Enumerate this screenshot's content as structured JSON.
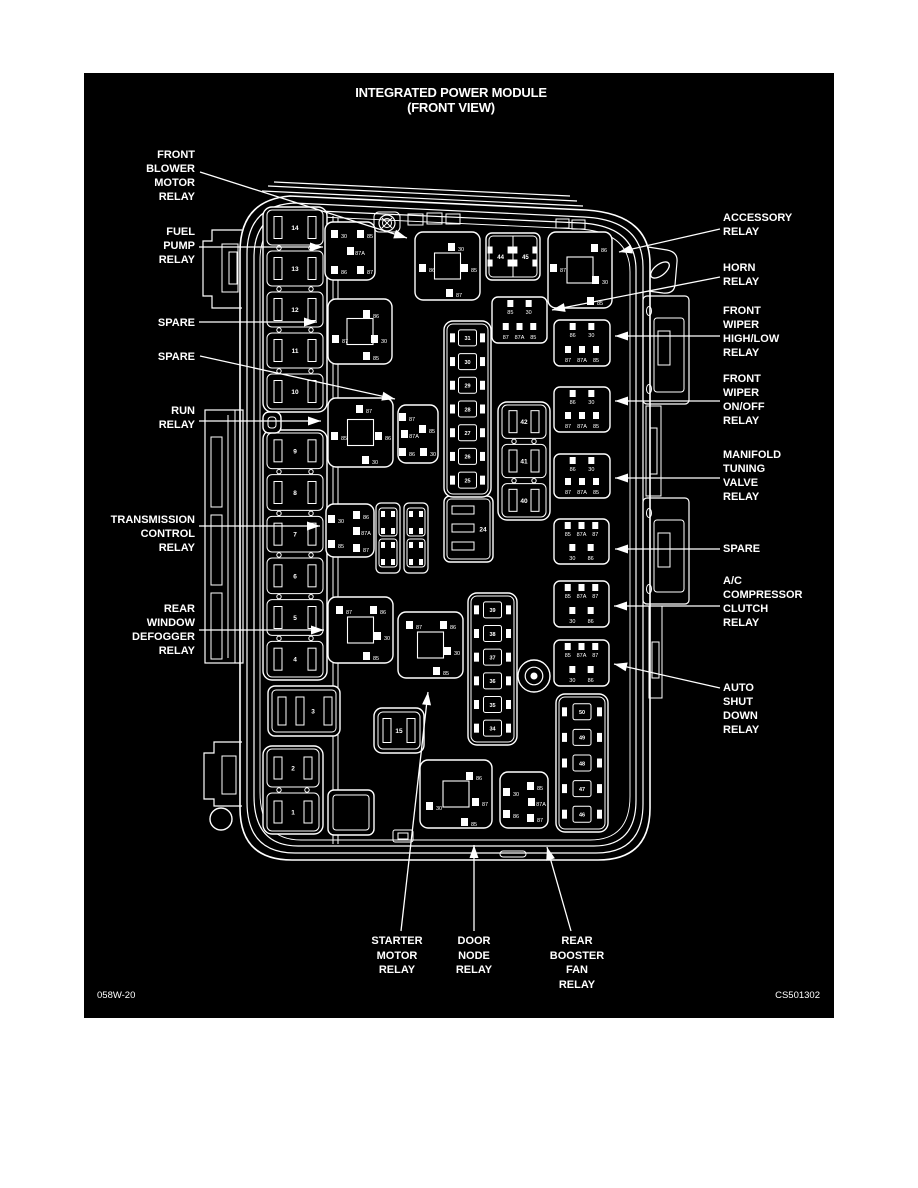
{
  "title": {
    "line1": "INTEGRATED POWER MODULE",
    "line2": "(FRONT VIEW)"
  },
  "footer": {
    "left": "058W-20",
    "right": "CS501302"
  },
  "colors": {
    "ink": "#ffffff",
    "paper": "#000000",
    "page": "#ffffff"
  },
  "callouts": [
    {
      "id": "front-blower-motor-relay",
      "side": "left",
      "x": 195,
      "lines": [
        "FRONT",
        "BLOWER",
        "MOTOR",
        "RELAY"
      ],
      "ys": [
        158,
        172,
        186,
        200
      ],
      "leader": [
        [
          200,
          172
        ],
        [
          407,
          238
        ]
      ]
    },
    {
      "id": "fuel-pump-relay",
      "side": "left",
      "x": 195,
      "lines": [
        "FUEL",
        "PUMP",
        "RELAY"
      ],
      "ys": [
        235,
        249,
        263
      ],
      "leader": [
        [
          199,
          247
        ],
        [
          323,
          247
        ]
      ]
    },
    {
      "id": "spare-1",
      "side": "left",
      "x": 195,
      "lines": [
        "SPARE"
      ],
      "ys": [
        326
      ],
      "leader": [
        [
          199,
          322
        ],
        [
          317,
          322
        ]
      ]
    },
    {
      "id": "spare-2",
      "side": "left",
      "x": 195,
      "lines": [
        "SPARE"
      ],
      "ys": [
        360
      ],
      "leader": [
        [
          200,
          356
        ],
        [
          395,
          399
        ]
      ]
    },
    {
      "id": "run-relay",
      "side": "left",
      "x": 195,
      "lines": [
        "RUN",
        "RELAY"
      ],
      "ys": [
        414,
        428
      ],
      "leader": [
        [
          199,
          421
        ],
        [
          321,
          421
        ]
      ]
    },
    {
      "id": "transmission-control-relay",
      "side": "left",
      "x": 195,
      "lines": [
        "TRANSMISSION",
        "CONTROL",
        "RELAY"
      ],
      "ys": [
        523,
        537,
        551
      ],
      "leader": [
        [
          199,
          526
        ],
        [
          320,
          526
        ]
      ]
    },
    {
      "id": "rear-window-defogger-relay",
      "side": "left",
      "x": 195,
      "lines": [
        "REAR",
        "WINDOW",
        "DEFOGGER",
        "RELAY"
      ],
      "ys": [
        612,
        626,
        640,
        654
      ],
      "leader": [
        [
          199,
          630
        ],
        [
          324,
          630
        ]
      ]
    },
    {
      "id": "accessory-relay",
      "side": "right",
      "x": 723,
      "lines": [
        "ACCESSORY",
        "RELAY"
      ],
      "ys": [
        221,
        235
      ],
      "leader": [
        [
          720,
          229
        ],
        [
          619,
          252
        ]
      ]
    },
    {
      "id": "horn-relay",
      "side": "right",
      "x": 723,
      "lines": [
        "HORN",
        "RELAY"
      ],
      "ys": [
        271,
        285
      ],
      "leader": [
        [
          720,
          277
        ],
        [
          552,
          310
        ]
      ]
    },
    {
      "id": "front-wiper-highlow-relay",
      "side": "right",
      "x": 723,
      "lines": [
        "FRONT",
        "WIPER",
        "HIGH/LOW",
        "RELAY"
      ],
      "ys": [
        314,
        328,
        342,
        356
      ],
      "leader": [
        [
          720,
          336
        ],
        [
          615,
          336
        ]
      ]
    },
    {
      "id": "front-wiper-onoff-relay",
      "side": "right",
      "x": 723,
      "lines": [
        "FRONT",
        "WIPER",
        "ON/OFF",
        "RELAY"
      ],
      "ys": [
        382,
        396,
        410,
        424
      ],
      "leader": [
        [
          720,
          401
        ],
        [
          615,
          401
        ]
      ]
    },
    {
      "id": "manifold-tuning-valve-relay",
      "side": "right",
      "x": 723,
      "lines": [
        "MANIFOLD",
        "TUNING",
        "VALVE",
        "RELAY"
      ],
      "ys": [
        458,
        472,
        486,
        500
      ],
      "leader": [
        [
          720,
          478
        ],
        [
          615,
          478
        ]
      ]
    },
    {
      "id": "spare-right",
      "side": "right",
      "x": 723,
      "lines": [
        "SPARE"
      ],
      "ys": [
        552
      ],
      "leader": [
        [
          720,
          549
        ],
        [
          615,
          549
        ]
      ]
    },
    {
      "id": "ac-compressor-clutch-relay",
      "side": "right",
      "x": 723,
      "lines": [
        "A/C",
        "COMPRESSOR",
        "CLUTCH",
        "RELAY"
      ],
      "ys": [
        584,
        598,
        612,
        626
      ],
      "leader": [
        [
          720,
          606
        ],
        [
          614,
          606
        ]
      ]
    },
    {
      "id": "auto-shut-down-relay",
      "side": "right",
      "x": 723,
      "lines": [
        "AUTO",
        "SHUT",
        "DOWN",
        "RELAY"
      ],
      "ys": [
        691,
        705,
        719,
        733
      ],
      "leader": [
        [
          720,
          688
        ],
        [
          614,
          664
        ]
      ]
    },
    {
      "id": "starter-motor-relay",
      "side": "bottom",
      "x": 397,
      "lines": [
        "STARTER",
        "MOTOR",
        "RELAY"
      ],
      "ys": [
        944,
        959,
        973
      ],
      "leader": [
        [
          401,
          931
        ],
        [
          428,
          692
        ]
      ]
    },
    {
      "id": "door-node-relay",
      "side": "bottom",
      "x": 474,
      "lines": [
        "DOOR",
        "NODE",
        "RELAY"
      ],
      "ys": [
        944,
        959,
        973
      ],
      "leader": [
        [
          474,
          931
        ],
        [
          474,
          845
        ]
      ]
    },
    {
      "id": "rear-booster-fan-relay",
      "side": "bottom",
      "x": 577,
      "lines": [
        "REAR",
        "BOOSTER",
        "FAN",
        "RELAY"
      ],
      "ys": [
        944,
        959,
        973,
        988
      ],
      "leader": [
        [
          571,
          931
        ],
        [
          547,
          847
        ]
      ]
    }
  ],
  "components": [
    {
      "id": "fuse-column-top",
      "type": "fusecol",
      "x": 263,
      "y": 207,
      "w": 64,
      "h": 205,
      "fuses": [
        "14",
        "13",
        "12",
        "11",
        "10"
      ]
    },
    {
      "id": "fuse-column-mid",
      "type": "fusecol",
      "x": 263,
      "y": 430,
      "w": 64,
      "h": 250,
      "fuses": [
        "9",
        "8",
        "7",
        "6",
        "5",
        "4"
      ]
    },
    {
      "id": "fuse-column-low",
      "type": "fusecol",
      "x": 263,
      "y": 746,
      "w": 60,
      "h": 88,
      "fuses": [
        "2",
        "1"
      ]
    },
    {
      "id": "fuse-column-42",
      "type": "fusecol",
      "x": 498,
      "y": 402,
      "w": 52,
      "h": 118,
      "fuses": [
        "42",
        "41",
        "40"
      ]
    },
    {
      "id": "fuse-box-3",
      "type": "hfuse",
      "x": 268,
      "y": 686,
      "w": 72,
      "h": 50,
      "label": "3"
    },
    {
      "id": "run-feed-box",
      "type": "blank",
      "x": 263,
      "y": 412,
      "w": 18,
      "h": 21
    },
    {
      "id": "blank-box",
      "type": "blank",
      "x": 328,
      "y": 790,
      "w": 46,
      "h": 45
    },
    {
      "id": "fuse-15",
      "type": "fuse15",
      "x": 374,
      "y": 708,
      "w": 50,
      "h": 45,
      "label": "15"
    },
    {
      "id": "fuse-24",
      "type": "vfuse",
      "x": 444,
      "y": 496,
      "w": 49,
      "h": 66,
      "label": "24"
    },
    {
      "id": "minifuse-column-upper",
      "type": "minicol",
      "x": 444,
      "y": 321,
      "w": 47,
      "h": 176,
      "fuses": [
        "31",
        "30",
        "29",
        "28",
        "27",
        "26",
        "25"
      ]
    },
    {
      "id": "minifuse-column-center",
      "type": "minicol",
      "x": 468,
      "y": 593,
      "w": 49,
      "h": 152,
      "fuses": [
        "39",
        "38",
        "37",
        "36",
        "35",
        "34"
      ]
    },
    {
      "id": "minifuse-column-right",
      "type": "minicol",
      "x": 556,
      "y": 694,
      "w": 52,
      "h": 138,
      "fuses": [
        "50",
        "49",
        "48",
        "47",
        "46"
      ]
    },
    {
      "id": "minifuse-strip-1",
      "type": "ministrip",
      "x": 376,
      "y": 503,
      "w": 24,
      "h": 70
    },
    {
      "id": "minifuse-strip-2",
      "type": "ministrip",
      "x": 404,
      "y": 503,
      "w": 24,
      "h": 70
    },
    {
      "id": "fuse-44-45",
      "type": "fusepair",
      "x": 486,
      "y": 233,
      "w": 54,
      "h": 47,
      "labels": [
        "44",
        "45"
      ]
    },
    {
      "id": "fuel-pump-relay",
      "type": "relay",
      "x": 325,
      "y": 222,
      "w": 50,
      "h": 58,
      "square": false,
      "pins": [
        {
          "t": "30",
          "x": 15,
          "y": 14
        },
        {
          "t": "85",
          "x": 41,
          "y": 14
        },
        {
          "t": "87A",
          "x": 31,
          "y": 31
        },
        {
          "t": "86",
          "x": 15,
          "y": 50
        },
        {
          "t": "87",
          "x": 41,
          "y": 50
        }
      ]
    },
    {
      "id": "front-blower-relay",
      "type": "relay",
      "x": 415,
      "y": 232,
      "w": 65,
      "h": 68,
      "square": true,
      "pins": [
        {
          "t": "30",
          "x": 42,
          "y": 17
        },
        {
          "t": "86",
          "x": 13,
          "y": 38
        },
        {
          "t": "85",
          "x": 55,
          "y": 38
        },
        {
          "t": "87",
          "x": 40,
          "y": 63
        }
      ]
    },
    {
      "id": "accessory-relay",
      "type": "relay",
      "x": 548,
      "y": 232,
      "w": 64,
      "h": 76,
      "square": true,
      "pins": [
        {
          "t": "87",
          "x": 11,
          "y": 38
        },
        {
          "t": "86",
          "x": 52,
          "y": 18
        },
        {
          "t": "30",
          "x": 53,
          "y": 50
        },
        {
          "t": "85",
          "x": 48,
          "y": 71
        }
      ]
    },
    {
      "id": "spare-relay-1",
      "type": "relay",
      "x": 328,
      "y": 299,
      "w": 64,
      "h": 65,
      "square": true,
      "pins": [
        {
          "t": "86",
          "x": 44,
          "y": 17
        },
        {
          "t": "30",
          "x": 52,
          "y": 42
        },
        {
          "t": "87",
          "x": 13,
          "y": 42
        },
        {
          "t": "85",
          "x": 44,
          "y": 59
        }
      ]
    },
    {
      "id": "run-relay",
      "type": "relay",
      "x": 328,
      "y": 398,
      "w": 65,
      "h": 69,
      "square": true,
      "pins": [
        {
          "t": "87",
          "x": 37,
          "y": 13
        },
        {
          "t": "85",
          "x": 12,
          "y": 40
        },
        {
          "t": "86",
          "x": 56,
          "y": 40
        },
        {
          "t": "30",
          "x": 43,
          "y": 64
        }
      ]
    },
    {
      "id": "spare-relay-2",
      "type": "relay",
      "x": 398,
      "y": 405,
      "w": 40,
      "h": 58,
      "square": false,
      "pins": [
        {
          "t": "87",
          "x": 10,
          "y": 14
        },
        {
          "t": "85",
          "x": 30,
          "y": 26
        },
        {
          "t": "87A",
          "x": 12,
          "y": 31
        },
        {
          "t": "86",
          "x": 10,
          "y": 49
        },
        {
          "t": "30",
          "x": 31,
          "y": 49
        }
      ]
    },
    {
      "id": "tcm-relay",
      "type": "relay",
      "x": 326,
      "y": 504,
      "w": 48,
      "h": 53,
      "square": false,
      "pins": [
        {
          "t": "30",
          "x": 11,
          "y": 17
        },
        {
          "t": "86",
          "x": 36,
          "y": 13
        },
        {
          "t": "87A",
          "x": 36,
          "y": 29
        },
        {
          "t": "85",
          "x": 11,
          "y": 42
        },
        {
          "t": "87",
          "x": 36,
          "y": 46
        }
      ]
    },
    {
      "id": "defogger-relay",
      "type": "relay",
      "x": 328,
      "y": 597,
      "w": 65,
      "h": 66,
      "square": true,
      "pins": [
        {
          "t": "87",
          "x": 17,
          "y": 15
        },
        {
          "t": "86",
          "x": 51,
          "y": 15
        },
        {
          "t": "30",
          "x": 55,
          "y": 41
        },
        {
          "t": "85",
          "x": 44,
          "y": 61
        }
      ]
    },
    {
      "id": "starter-relay",
      "type": "relay",
      "x": 398,
      "y": 612,
      "w": 65,
      "h": 66,
      "square": true,
      "pins": [
        {
          "t": "87",
          "x": 17,
          "y": 15
        },
        {
          "t": "86",
          "x": 51,
          "y": 15
        },
        {
          "t": "30",
          "x": 55,
          "y": 41
        },
        {
          "t": "85",
          "x": 44,
          "y": 61
        }
      ]
    },
    {
      "id": "door-node-relay",
      "type": "relay",
      "x": 420,
      "y": 760,
      "w": 72,
      "h": 68,
      "square": true,
      "pins": [
        {
          "t": "86",
          "x": 55,
          "y": 18
        },
        {
          "t": "87",
          "x": 61,
          "y": 44
        },
        {
          "t": "30",
          "x": 15,
          "y": 48
        },
        {
          "t": "85",
          "x": 50,
          "y": 64
        }
      ]
    },
    {
      "id": "booster-relay",
      "type": "relay",
      "x": 500,
      "y": 772,
      "w": 48,
      "h": 56,
      "square": false,
      "pins": [
        {
          "t": "30",
          "x": 12,
          "y": 22
        },
        {
          "t": "86",
          "x": 12,
          "y": 44
        },
        {
          "t": "85",
          "x": 36,
          "y": 16
        },
        {
          "t": "87A",
          "x": 37,
          "y": 32
        },
        {
          "t": "87",
          "x": 36,
          "y": 48
        }
      ]
    },
    {
      "id": "horn-relay",
      "type": "micro",
      "x": 492,
      "y": 297,
      "w": 55,
      "h": 46,
      "top": [
        "85",
        "30"
      ],
      "bottom": [
        "87",
        "87A",
        "85"
      ]
    },
    {
      "id": "wiper-highlow-relay",
      "type": "micro",
      "x": 554,
      "y": 320,
      "w": 56,
      "h": 46,
      "top": [
        "86",
        "30"
      ],
      "bottom": [
        "87",
        "87A",
        "85"
      ]
    },
    {
      "id": "wiper-onoff-relay",
      "type": "micro",
      "x": 554,
      "y": 387,
      "w": 56,
      "h": 45,
      "top": [
        "86",
        "30"
      ],
      "bottom": [
        "87",
        "87A",
        "85"
      ]
    },
    {
      "id": "manifold-relay",
      "type": "micro",
      "x": 554,
      "y": 454,
      "w": 56,
      "h": 44,
      "top": [
        "86",
        "30"
      ],
      "bottom": [
        "87",
        "87A",
        "85"
      ]
    },
    {
      "id": "spare-relay-right",
      "type": "micro",
      "x": 554,
      "y": 519,
      "w": 55,
      "h": 45,
      "top": [
        "85",
        "87A",
        "87"
      ],
      "bottom": [
        "30",
        "86"
      ]
    },
    {
      "id": "ac-clutch-relay",
      "type": "micro",
      "x": 554,
      "y": 581,
      "w": 55,
      "h": 46,
      "top": [
        "85",
        "87A",
        "87"
      ],
      "bottom": [
        "30",
        "86"
      ]
    },
    {
      "id": "asd-relay",
      "type": "micro",
      "x": 554,
      "y": 640,
      "w": 55,
      "h": 46,
      "top": [
        "85",
        "87A",
        "87"
      ],
      "bottom": [
        "30",
        "86"
      ]
    },
    {
      "id": "stud",
      "type": "stud",
      "cx": 534,
      "cy": 676,
      "r": 16
    }
  ]
}
